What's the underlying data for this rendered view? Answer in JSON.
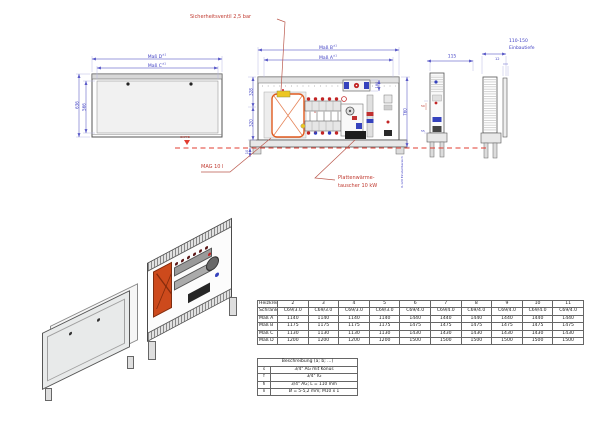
{
  "colors": {
    "dimension_blue": "#4040c4",
    "line_blue": "#9a9ade",
    "annotation_red": "#c03a30",
    "mag_orange": "#e05a1e",
    "valve_yellow": "#ecc623"
  },
  "drawing": {
    "tolerance": "±1",
    "annotations": {
      "safety_valve": "Sicherheitsventil 2,5 bar",
      "mag": "MAG 10 l",
      "heat_exchanger_line1": "Plattenwärme-",
      "heat_exchanger_line2": "tauscher 10 kW",
      "floor_level": "OKFFB",
      "port_label": "a"
    },
    "front_view": {
      "dim_d": "Maß D",
      "dim_c": "Maß C",
      "dim_height_outer": "636",
      "dim_height_inner": "566"
    },
    "elevation_view": {
      "dim_b": "Maß B",
      "dim_a": "Maß A",
      "dim_left_top": "328",
      "dim_left_bottom": "320",
      "dim_right": "760",
      "dim_component": "180",
      "dim_base": "10",
      "adjust_range": "0-120 Einstellbereich"
    },
    "side_view_1": {
      "dim_width": "115",
      "dim_upper": "50",
      "dim_lower": "55"
    },
    "side_view_2": {
      "depth_range": "110-150",
      "depth_label": "Einbautiefe",
      "dim_plate": "12"
    }
  },
  "size_table": {
    "rows": [
      [
        "Heizkreise",
        "2",
        "3",
        "4",
        "5",
        "6",
        "7",
        "8",
        "9",
        "10",
        "11"
      ],
      [
        "Schranktyp",
        "C69/3.0",
        "C69/3.0",
        "C69/3.0",
        "C69/3.0",
        "C69/4.0",
        "C69/4.0",
        "C69/4.0",
        "C69/4.0",
        "C69/4.0",
        "C69/4.0"
      ],
      [
        "Maß A",
        "1140",
        "1140",
        "1140",
        "1140",
        "1440",
        "1440",
        "1440",
        "1440",
        "1440",
        "1440"
      ],
      [
        "Maß B",
        "1175",
        "1175",
        "1175",
        "1175",
        "1475",
        "1475",
        "1475",
        "1475",
        "1475",
        "1475"
      ],
      [
        "Maß C",
        "1130",
        "1130",
        "1130",
        "1130",
        "1430",
        "1430",
        "1430",
        "1430",
        "1430",
        "1430"
      ],
      [
        "Maß D",
        "1200",
        "1200",
        "1200",
        "1200",
        "1500",
        "1500",
        "1500",
        "1500",
        "1500",
        "1500"
      ]
    ]
  },
  "legend": {
    "title": "Beschreibung (a; b; ...)",
    "rows": [
      [
        "s",
        "3/4\" AG mit Konus"
      ],
      [
        "f",
        "3/4\" IG"
      ],
      [
        "h",
        "3/4\" AG; L = 110 mm"
      ],
      [
        "n",
        "Ø = 5-5,2 mm; M10 x 1"
      ]
    ]
  }
}
